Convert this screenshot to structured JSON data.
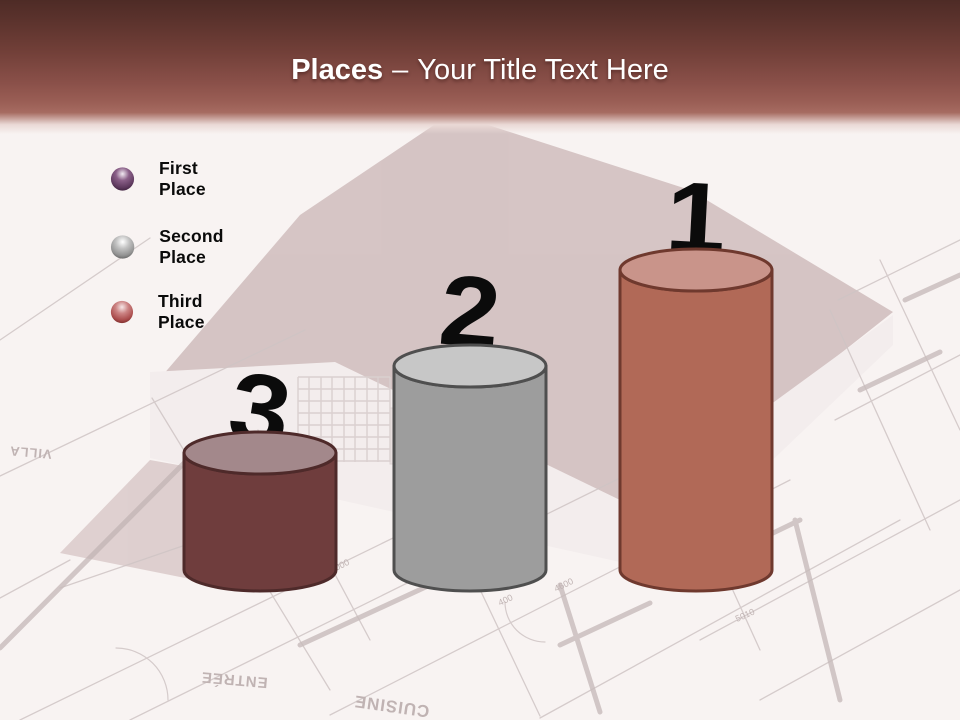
{
  "title": {
    "emphasis": "Places",
    "separator": "–",
    "text": "Your Title Text Here"
  },
  "theme": {
    "header_top": "#4e2b26",
    "header_bottom": "#a66b61",
    "page_bg": "#f8f3f2",
    "title_color": "#ffffff",
    "number_color": "#0b0b0b"
  },
  "legend": {
    "items": [
      {
        "label": "First Place",
        "ball": {
          "hi": "#f2eaf2",
          "mid": "#8a5f88",
          "base": "#5f3a5f",
          "edge": "#3d203d"
        }
      },
      {
        "label": "Second Place",
        "ball": {
          "hi": "#ffffff",
          "mid": "#c2c2c2",
          "base": "#929292",
          "edge": "#636363"
        }
      },
      {
        "label": "Third Place",
        "ball": {
          "hi": "#f6e7e7",
          "mid": "#cc8484",
          "base": "#aa4c4c",
          "edge": "#7a2b2b"
        }
      }
    ]
  },
  "podium": {
    "items": [
      {
        "rank": "3",
        "place": "Third Place",
        "body": "#6f3d3d",
        "top": "#a3888b",
        "stroke": "#4e2a2a",
        "height_px": 139
      },
      {
        "rank": "2",
        "place": "Second Place",
        "body": "#9d9d9d",
        "top": "#c7c7c7",
        "stroke": "#4f4f4f",
        "height_px": 226
      },
      {
        "rank": "1",
        "place": "First Place",
        "body": "#b16957",
        "top": "#c9948a",
        "stroke": "#6f392e",
        "height_px": 322
      }
    ]
  },
  "chart_data": {
    "type": "bar",
    "title": "Places – Your Title Text Here",
    "categories": [
      "Third Place",
      "Second Place",
      "First Place"
    ],
    "series": [
      {
        "name": "podium_cylinder_height_px",
        "values": [
          139,
          226,
          322
        ]
      }
    ],
    "order_left_to_right": [
      "3",
      "2",
      "1"
    ],
    "legend_position": "upper-left"
  },
  "background": {
    "house": {
      "roof": "#cdb9b9",
      "roof_light": "#d8c7c7",
      "wall": "#f2ecec",
      "window": "#e6dcdc",
      "chimney": "#c9b4b4",
      "lattice_line": "#d3c8c8"
    },
    "blueprint": {
      "thin_line": "#cfc5c5",
      "thick_line": "#bfb2b2",
      "text_color": "#b7a9a9"
    },
    "words": [
      {
        "text": "VILLA"
      },
      {
        "text": "ENTRÉE"
      },
      {
        "text": "CUISINE"
      }
    ],
    "dims": [
      {
        "text": "4000"
      },
      {
        "text": "4600"
      },
      {
        "text": "400"
      },
      {
        "text": "5010"
      }
    ]
  }
}
